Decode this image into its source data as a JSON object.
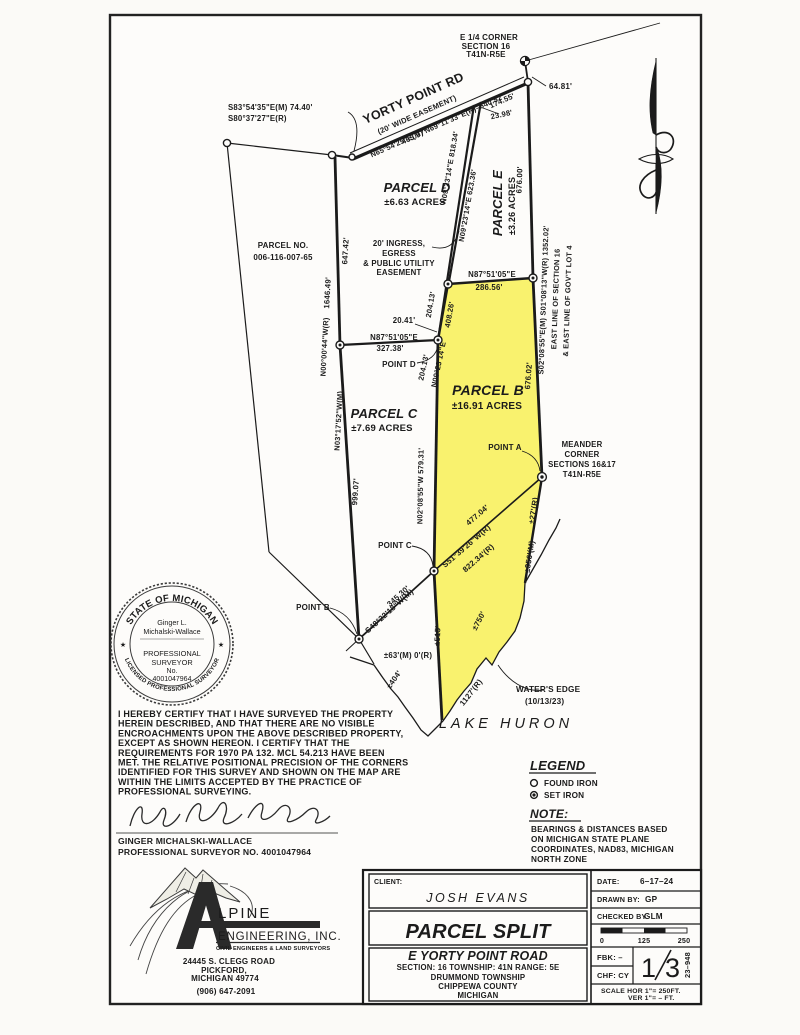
{
  "map": {
    "corner_note": [
      "E 1/4 CORNER",
      "SECTION 16",
      "T41N-R5E"
    ],
    "road": {
      "name": "YORTY POINT RD",
      "easement": "(20' WIDE EASEMENT)",
      "bearing": "N65°54'25\"E(M)  N69°11'33\"E(R)–640.52'",
      "d465": "465.97'",
      "d174": "174.55'",
      "d23": "23.98'",
      "d64": "64.81'"
    },
    "tie_m": "S83°54'35\"E(M)  74.40'",
    "tie_r": "S80°37'27\"E(R)",
    "adjacent_parcel": [
      "PARCEL NO.",
      "006-116-007-65"
    ],
    "west_line": {
      "seg_upper": "647.42'",
      "total": "1646.49'",
      "bearing_r": "N00°00'44\"W(R)",
      "bearing_m": "N03°17'52\"W(M)",
      "seg_lower": "999.07'"
    },
    "east_line": {
      "seg_upper": "676.00'",
      "bearing": "S02°08'55\"E(M)  S01°08'13\"W(R)  1352.02'",
      "label1": "EAST LINE OF SECTION 16",
      "label2": "& EAST LINE OF GOV'T LOT 4",
      "seg_lower": "676.02'"
    },
    "easement_note": [
      "20' INGRESS,",
      "EGRESS",
      "& PUBLIC UTILITY",
      "EASEMENT"
    ],
    "parcels": {
      "d_name": "PARCEL D",
      "d_acres": "±6.63 ACRES",
      "e_name": "PARCEL E",
      "e_acres": "±3.26 ACRES",
      "b_name": "PARCEL B",
      "b_acres": "±16.91 ACRES",
      "c_name": "PARCEL C",
      "c_acres": "±7.69 ACRES"
    },
    "dims": {
      "n0923_818": "N09°23'14\"E 818.34'",
      "n0923_623": "N09°23'14\"E 623.36'",
      "n87": "N87°51'05\"E",
      "n87_dist": "327.38'",
      "d2041": "20.41'",
      "d20413a": "204.13'",
      "d40826": "408.26'",
      "d20413b": "204.13'",
      "n0923": "N09°23'14\"E",
      "n87_286": "N87°51'05\"E",
      "d28656": "286.56'",
      "n0208_579": "N02°08'55\"W 579.31'",
      "s51_dist": "477.04'",
      "s51_bearing": "S51°39'26\"W(R)",
      "s51_record": "822.34'(R)",
      "s48_dist": "345.30'",
      "s48_bearing": "S48°22'18\"W(M)",
      "d27": "±27'(R)",
      "d356": "±356'(M)",
      "d63": "±63'(M)  0'(R)",
      "d404": "±404'",
      "d515": "±515'",
      "d750": "±750'",
      "d1127": "1127'(R)"
    },
    "points": {
      "a": "POINT A",
      "b": "POINT B",
      "c": "POINT C",
      "d": "POINT D"
    },
    "meander": [
      "MEANDER",
      "CORNER",
      "SECTIONS 16&17",
      "T41N-R5E"
    ],
    "water": {
      "edge1": "WATER'S EDGE",
      "edge2": "(10/13/23)",
      "lake": "LAKE HURON"
    }
  },
  "seal": {
    "arc_top": "STATE OF MICHIGAN",
    "arc_bottom": "LICENSED PROFESSIONAL SURVEYOR",
    "star_left": "★",
    "star_right": "★",
    "name1": "Ginger L.",
    "name2": "Michalski-Wallace",
    "line3": "PROFESSIONAL",
    "line4": "SURVEYOR",
    "line5": "No.",
    "line6": "4001047964"
  },
  "cert": {
    "lines": [
      "I HEREBY CERTIFY THAT I HAVE SURVEYED THE PROPERTY",
      "HEREIN DESCRIBED, AND THAT THERE ARE NO VISIBLE",
      "ENCROACHMENTS UPON THE ABOVE DESCRIBED PROPERTY,",
      "EXCEPT AS SHOWN HEREON.  I CERTIFY THAT THE",
      "REQUIREMENTS FOR 1970 PA 132. MCL 54.213 HAVE BEEN",
      "MET.  THE RELATIVE POSITIONAL PRECISION OF THE CORNERS",
      "IDENTIFIED FOR THIS SURVEY AND SHOWN ON THE MAP ARE",
      "WITHIN THE LIMITS ACCEPTED BY THE PRACTICE OF",
      "PROFESSIONAL SURVEYING."
    ],
    "surveyor_name": "GINGER MICHALSKI-WALLACE",
    "surveyor_no": "PROFESSIONAL SURVEYOR NO. 4001047964"
  },
  "legend": {
    "title": "LEGEND",
    "found": "FOUND IRON",
    "set": "SET IRON"
  },
  "note": {
    "title": "NOTE:",
    "lines": [
      "BEARINGS & DISTANCES BASED",
      "ON MICHIGAN STATE PLANE",
      "COORDINATES, NAD83, MICHIGAN",
      "NORTH ZONE"
    ]
  },
  "firm": {
    "name_rest": "LPINE",
    "line2": "ENGINEERING, INC.",
    "line3": "CIVIL ENGINEERS & LAND SURVEYORS",
    "addr1": "24445 S. CLEGG ROAD",
    "addr2": "PICKFORD,",
    "addr3": "MICHIGAN 49774",
    "phone": "(906) 647-2091"
  },
  "tb": {
    "client_label": "CLIENT:",
    "client": "JOSH EVANS",
    "title": "PARCEL SPLIT",
    "road": "E YORTY POINT ROAD",
    "strs": "SECTION: 16      TOWNSHIP: 41N      RANGE: 5E",
    "twp": "DRUMMOND TOWNSHIP",
    "county": "CHIPPEWA COUNTY",
    "state": "MICHIGAN",
    "date_label": "DATE:",
    "date": "6–17–24",
    "drawn_label": "DRAWN BY:",
    "drawn": "GP",
    "checked_label": "CHECKED BY:",
    "checked": "GLM",
    "tick0": "0",
    "tick125": "125",
    "tick250": "250",
    "fbk": "FBK: –",
    "chf": "CHF: CY",
    "sheet_num": "1",
    "sheet_total": "3",
    "job": "23–948",
    "scale1": "SCALE   HOR 1\"= 250FT.",
    "scale2": "VER 1\"= –    FT."
  },
  "colors": {
    "highlight": "#f6ee38",
    "ink": "#1b1b1b",
    "paper": "#fcfbf8"
  }
}
